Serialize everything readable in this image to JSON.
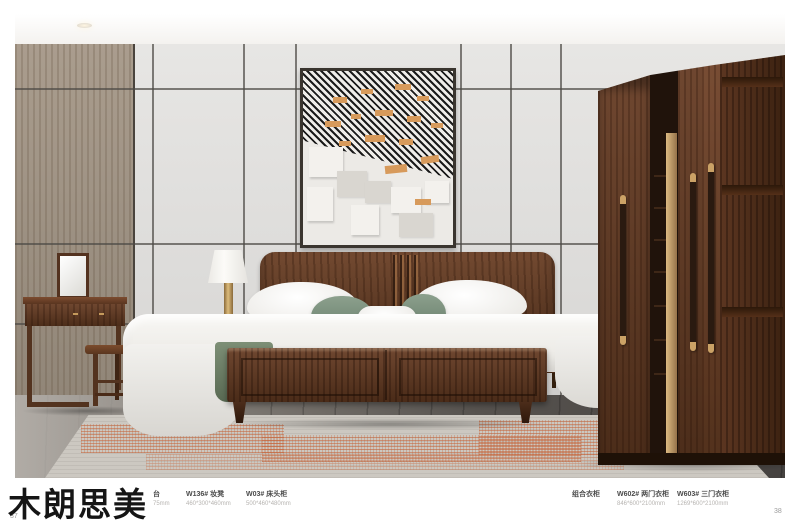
{
  "brand": {
    "name": "木朗思美"
  },
  "page": {
    "left_number": "37",
    "right_number": "38"
  },
  "products": [
    {
      "name": "台",
      "dims": "75mm"
    },
    {
      "name": "W136# 妆凳",
      "dims": "460*300*460mm"
    },
    {
      "name": "W03# 床头柜",
      "dims": "500*460*480mm"
    },
    {
      "name": "组合衣柜",
      "dims": ""
    },
    {
      "name": "W602# 两门衣柜",
      "dims": "846*600*2100mm"
    },
    {
      "name": "W603# 三门衣柜",
      "dims": "1269*600*2100mm"
    }
  ],
  "colors": {
    "wood_primary": "#5e3a24",
    "wall_gray": "#e0dfdd",
    "wood_wall_panel": "#a29586",
    "rug_accent": "#c9714a",
    "bedding_green": "#7e927e",
    "brass": "#c3995c",
    "floor_dark": "#514c48"
  }
}
